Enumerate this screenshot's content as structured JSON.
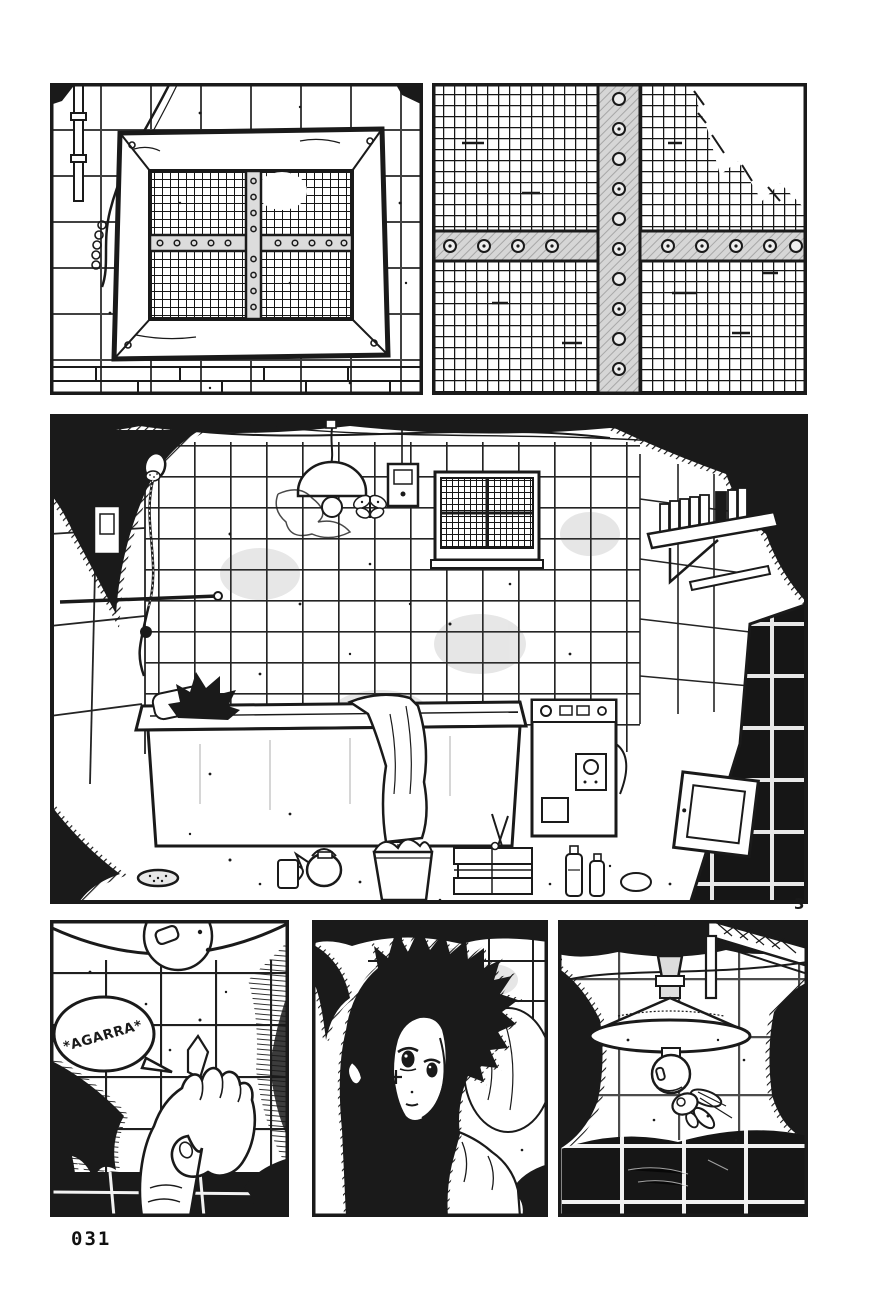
{
  "page": {
    "footer_page_number": "031",
    "panel_number_marker": "3"
  },
  "speech_bubbles": {
    "agarra": "*AGARRA*"
  },
  "colors": {
    "ink": "#1a1a1a",
    "paper": "#ffffff"
  }
}
